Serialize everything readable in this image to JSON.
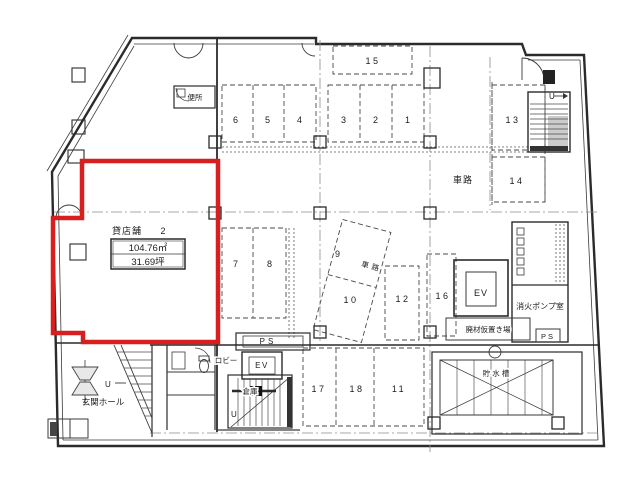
{
  "colors": {
    "highlight": "#d81f1f",
    "wall": "#2b2b2b"
  },
  "unit": {
    "name": "貸店舗",
    "number": "2",
    "area_m2": "104.76㎡",
    "area_tsubo": "31.69坪"
  },
  "rooms": {
    "toilet_upper": "便所",
    "entrance_hall": "玄関ホール",
    "lobby": "ロビー",
    "storage": "倉庫",
    "elevator_lower": "EV",
    "elevator_right": "EV",
    "pipe_shaft_lower": "PS",
    "pipe_shaft_right": "PS",
    "fire_pump_room": "消火ポンプ室",
    "waste_storage": "廃材仮置き場",
    "water_tank": "貯水槽",
    "driveway_right": "車路",
    "driveway_center": "車路",
    "stairs_up_right": "U",
    "stairs_up_lower": "U",
    "stairs_up_entrance": "U"
  },
  "parking": {
    "spaces": [
      "1",
      "2",
      "3",
      "4",
      "5",
      "6",
      "7",
      "8",
      "9",
      "10",
      "11",
      "12",
      "13",
      "14",
      "15",
      "16",
      "17",
      "18"
    ]
  }
}
